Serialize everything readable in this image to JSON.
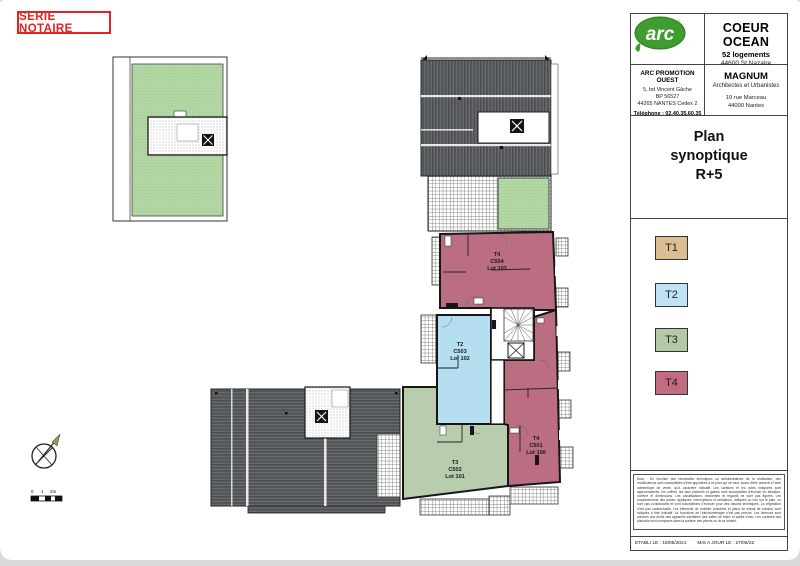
{
  "sheet": {
    "series_label": "SERIE NOTAIRE"
  },
  "title_block": {
    "logo": {
      "group": "GROUPE",
      "brand": "arc"
    },
    "project": {
      "name": "COEUR OCEAN",
      "program": "52 logements",
      "city": "44600 St Nazaire"
    },
    "promoter": {
      "name": "ARC PROMOTION OUEST",
      "address1": "5, bd Vincent Gâche",
      "address2": "BP 56527",
      "address3": "44265 NANTES Cedex 2",
      "phone": "Téléphone : 02.40.35.60.35"
    },
    "architect": {
      "name": "MAGNUM",
      "role": "Architectes et Urbanistes",
      "address1": "10 rue Marceau",
      "address2": "44000 Nantes"
    },
    "plan_title": {
      "line1": "Plan",
      "line2": "synoptique",
      "line3": "R+5"
    },
    "legend": {
      "items": [
        {
          "label": "T1",
          "color": "#ddbe93"
        },
        {
          "label": "T2",
          "color": "#bfe3f4"
        },
        {
          "label": "T3",
          "color": "#b4c9a6"
        },
        {
          "label": "T4",
          "color": "#c16c80"
        }
      ]
    },
    "notes": "Nota : En fonction des nécessités techniques ou administratives de la réalisation, des modifications sont susceptibles d'être apportées à ce plan qui ne vaut, avant d'être annexé à l'acte authentique de vente, qu'à caractère indicatif. Les surfaces et les cotes indiquées sont approximatives, les coffres, les faux plafonds et gaines sont susceptibles d'évoluer en situation, nombre et dimensions. Les canalisations, descentes et regards ne sont pas figurés. Les emplacements des prises, appliques, interrupteurs et radiateurs, indiqués ou non sur le plan, ne sont pas contractuels et sont susceptibles d'évoluer pour des raisons techniques. La végétation n'est pas contractuelle. Les éléments de mobilier (meubles et plans de travail de cuisine) sont indiqués à titre indicatif. La fourniture de l'électroménager n'est pas prévue. Les faïences sont prévues aux droits des appareils sanitaires des salles de bains et salles d'eau. Les surfaces des placards sont comprises dans la surface des pièces où ils se situent.",
    "footer": {
      "established": "ETABLI LE : 18/05/2021",
      "updated": "MIS A JOUR LE : 27/06/22"
    }
  },
  "plan": {
    "units": [
      {
        "type": "T4",
        "code": "C504",
        "lot": "Lot 103",
        "color": "#bb6e81"
      },
      {
        "type": "T2",
        "code": "C503",
        "lot": "Lot 102",
        "color": "#b5dff1"
      },
      {
        "type": "T3",
        "code": "C502",
        "lot": "Lot 101",
        "color": "#b7cdad"
      },
      {
        "type": "T4",
        "code": "C501",
        "lot": "Lot 100",
        "color": "#bb6e81"
      }
    ],
    "scale_ticks": [
      "0",
      "1",
      "2m"
    ],
    "colors": {
      "garden": "#b2d7a4",
      "roof": "#5a5e60",
      "wall": "#161616"
    }
  }
}
